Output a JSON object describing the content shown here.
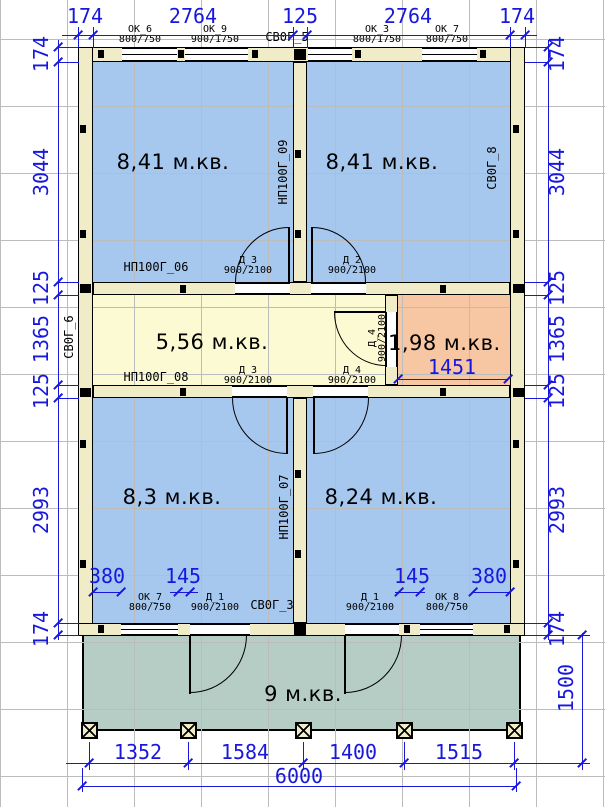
{
  "plan": {
    "rooms": {
      "top_left": "8,41 м.кв.",
      "top_right": "8,41 м.кв.",
      "hall": "5,56 м.кв.",
      "storage": "1,98 м.кв.",
      "bottom_left": "8,3 м.кв.",
      "bottom_right": "8,24 м.кв.",
      "porch": "9 м.кв."
    },
    "windows": {
      "ok6": {
        "name": "ОК_6",
        "size": "800/750"
      },
      "ok9": {
        "name": "ОК_9",
        "size": "900/1750"
      },
      "ok3": {
        "name": "ОК_3",
        "size": "800/1750"
      },
      "ok7_top": {
        "name": "ОК_7",
        "size": "800/750"
      },
      "ok7_bottom": {
        "name": "ОК_7",
        "size": "800/750"
      },
      "ok8": {
        "name": "ОК_8",
        "size": "800/750"
      }
    },
    "doors": {
      "top_left": {
        "name": "Д_3",
        "size": "900/2100"
      },
      "top_right": {
        "name": "Д_2",
        "size": "900/2100"
      },
      "bottom_left": {
        "name": "Д_3",
        "size": "900/2100"
      },
      "bottom_right": {
        "name": "Д_4",
        "size": "900/2100"
      },
      "storage": {
        "name": "Д_4",
        "size": "900/2100"
      },
      "entry_left": {
        "name": "Д_1",
        "size": "900/2100"
      },
      "entry_right": {
        "name": "Д_1",
        "size": "900/2100"
      }
    },
    "panels": {
      "top_center": "СВ0Г_5",
      "right_top": "СВ0Г_8",
      "left_middle": "СВ0Г_6",
      "bottom_center": "СВ0Г_3",
      "top_left_room": "НП100Г_06",
      "center_top": "НП100Г_09",
      "hall_bottom": "НП100Г_08",
      "center_bottom": "НП100Г_07"
    },
    "dims": {
      "top": [
        "174",
        "2764",
        "125",
        "2764",
        "174"
      ],
      "left": [
        "174",
        "3044",
        "125",
        "1365",
        "125",
        "2993",
        "174"
      ],
      "right": [
        "174",
        "3044",
        "125",
        "1365",
        "125",
        "2993",
        "174"
      ],
      "porch_depth": "1500",
      "bottom_segments": [
        "1352",
        "1584",
        "1400",
        "1515"
      ],
      "total_width": "6000",
      "storage_width": "1451",
      "offsets_left": [
        "380",
        "145"
      ],
      "offsets_right": [
        "145",
        "380"
      ]
    },
    "colors": {
      "room_fill": "#a6c8ef",
      "hall_fill": "#fbfad2",
      "storage_fill": "#f7c6a2",
      "porch_fill": "#b6cdc6",
      "wall_fill": "#efecc7",
      "dimension": "#1717dd",
      "grid": "#bcbcbc",
      "outline": "#000000"
    }
  }
}
